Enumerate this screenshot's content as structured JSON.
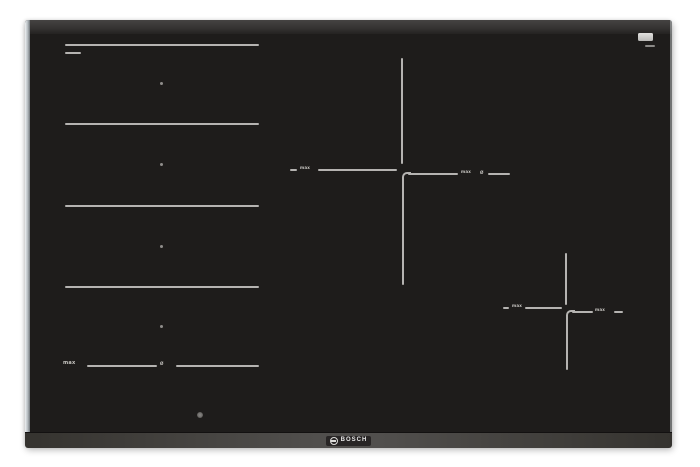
{
  "scene": {
    "type": "product-photo",
    "subject": "Black glass flex-induction cooktop viewed from above on a white background"
  },
  "colors": {
    "page_background": "#ffffff",
    "glass_surface": "#1e1c1b",
    "zone_markings": "#b5b3b1",
    "left_bevel_silver": "#c9ced2",
    "front_trim": "#4a4846",
    "corner_sticker": "#d6d5d3",
    "logo_text": "#e8e8e8"
  },
  "labels": {
    "max": "max",
    "diameter": "Ø"
  },
  "brand": {
    "name": "BOSCH",
    "icon": "bosch-armature-icon"
  },
  "zones": {
    "flex_zone_lines": 5,
    "flex_zone_dots": 4,
    "cross_zones": 2
  }
}
